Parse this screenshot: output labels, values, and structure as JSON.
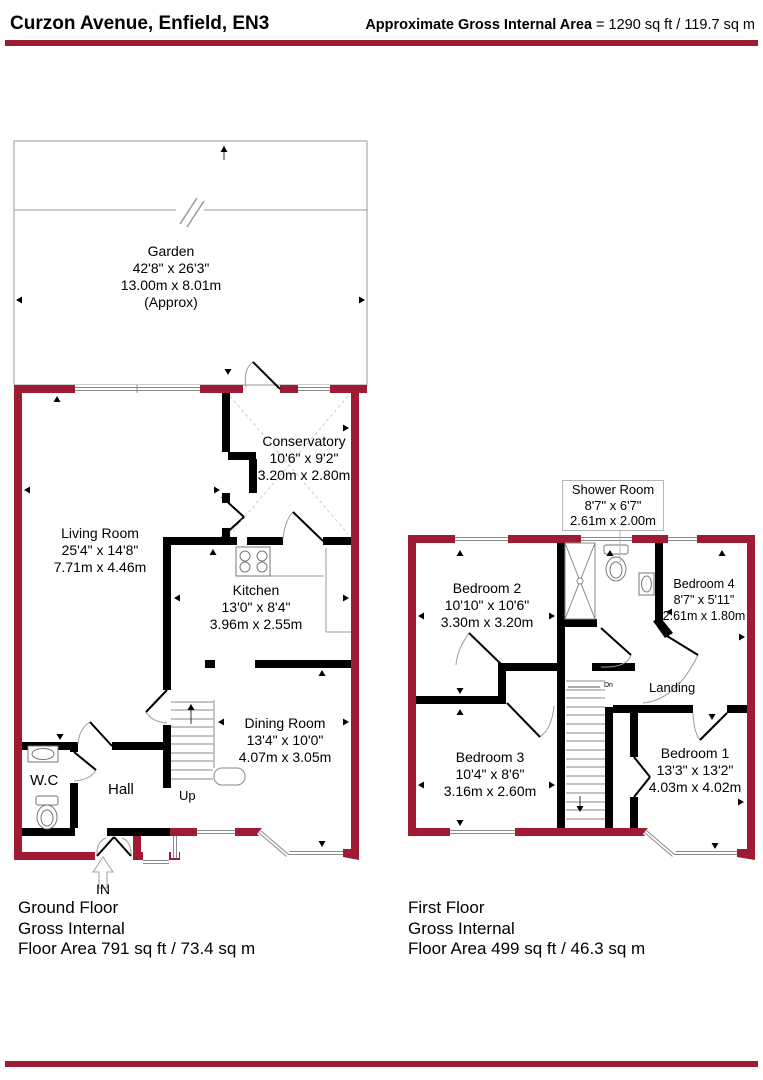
{
  "header": {
    "title": "Curzon Avenue, Enfield, EN3",
    "area_label": "Approximate Gross Internal Area",
    "area_value": " = 1290 sq ft / 119.7 sq m"
  },
  "colors": {
    "exterior_wall": "#9E1B33",
    "interior_wall": "#000000",
    "accent_bar": "#9E1B33",
    "window_line": "#8A8A8A"
  },
  "ground_floor": {
    "rooms": {
      "garden": {
        "name": "Garden",
        "imperial": "42'8\" x 26'3\"",
        "metric": "13.00m x 8.01m",
        "approx": "(Approx)"
      },
      "conservatory": {
        "name": "Conservatory",
        "imperial": "10'6\" x 9'2\"",
        "metric": "3.20m x 2.80m"
      },
      "living_room": {
        "name": "Living Room",
        "imperial": "25'4\" x 14'8\"",
        "metric": "7.71m x 4.46m"
      },
      "kitchen": {
        "name": "Kitchen",
        "imperial": "13'0\" x 8'4\"",
        "metric": "3.96m x 2.55m"
      },
      "dining_room": {
        "name": "Dining Room",
        "imperial": "13'4\" x 10'0\"",
        "metric": "4.07m x 3.05m"
      }
    },
    "labels": {
      "wc": "W.C",
      "hall": "Hall",
      "up": "Up",
      "in": "IN"
    },
    "footer": [
      "Ground Floor",
      "Gross Internal",
      "Floor Area 791 sq ft / 73.4 sq m"
    ]
  },
  "first_floor": {
    "rooms": {
      "shower_room": {
        "name": "Shower Room",
        "imperial": "8'7\" x 6'7\"",
        "metric": "2.61m x 2.00m"
      },
      "bedroom_2": {
        "name": "Bedroom 2",
        "imperial": "10'10\" x 10'6\"",
        "metric": "3.30m x 3.20m"
      },
      "bedroom_4": {
        "name": "Bedroom 4",
        "imperial": "8'7\" x 5'11\"",
        "metric": "2.61m x 1.80m"
      },
      "bedroom_3": {
        "name": "Bedroom 3",
        "imperial": "10'4\" x 8'6\"",
        "metric": "3.16m x 2.60m"
      },
      "bedroom_1": {
        "name": "Bedroom 1",
        "imperial": "13'3\" x 13'2\"",
        "metric": "4.03m x 4.02m"
      }
    },
    "labels": {
      "landing": "Landing",
      "dn": "Dn"
    },
    "footer": [
      "First Floor",
      "Gross Internal",
      "Floor Area 499 sq ft / 46.3 sq m"
    ]
  },
  "icons": {
    "entrance_arrow": "↑",
    "stair_up_tick": "▲",
    "stair_down_tick": "▼",
    "dn_arrow": "←"
  }
}
